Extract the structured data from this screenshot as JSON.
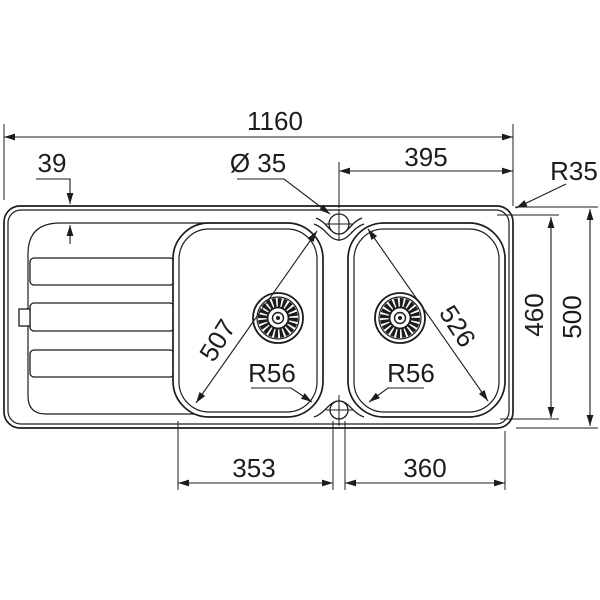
{
  "drawing": {
    "kind": "sink-dimension-drawing",
    "colors": {
      "line": "#1c1c1c",
      "background": "#ffffff"
    },
    "dimensions": {
      "overall_width": "1160",
      "drainer_offset": "39",
      "hole_diameter": "Ø 35",
      "right_section_width": "395",
      "rim_corner_radius": "R35",
      "basin_depth": "460",
      "overall_depth": "500",
      "left_bowl_diagonal": "507",
      "right_bowl_diagonal": "526",
      "left_bowl_radius": "R56",
      "right_bowl_radius": "R56",
      "left_bowl_width": "353",
      "right_bowl_width": "360"
    }
  }
}
